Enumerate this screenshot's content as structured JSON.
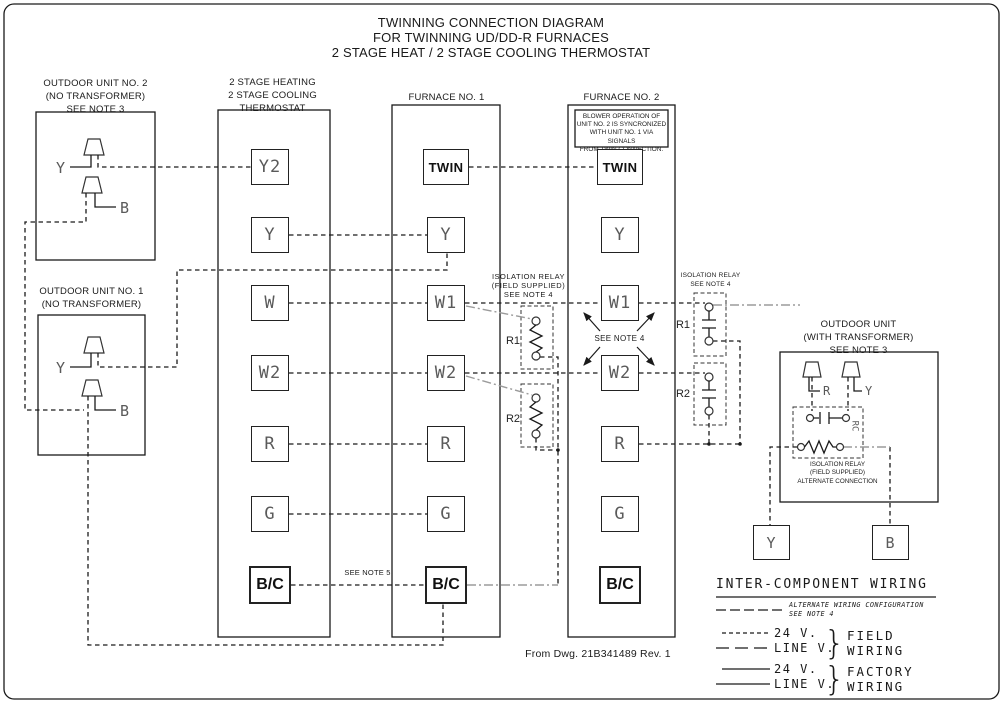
{
  "colors": {
    "line": "#1a1a1a",
    "alternate_wiring": "#9b9b9b"
  },
  "title": {
    "line1": "TWINNING CONNECTION DIAGRAM",
    "line2": "FOR TWINNING UD/DD-R FURNACES",
    "line3": "2 STAGE HEAT / 2 STAGE COOLING THERMOSTAT"
  },
  "outdoor_unit_2": {
    "label1": "OUTDOOR UNIT NO. 2",
    "label2": "(NO TRANSFORMER)",
    "label3": "SEE NOTE 3",
    "terminal_y": "Y",
    "terminal_b": "B"
  },
  "outdoor_unit_1": {
    "label1": "OUTDOOR UNIT NO. 1",
    "label2": "(NO TRANSFORMER)",
    "terminal_y": "Y",
    "terminal_b": "B"
  },
  "thermostat": {
    "header1": "2 STAGE HEATING",
    "header2": "2 STAGE COOLING",
    "header3": "THERMOSTAT",
    "terminals": [
      "Y2",
      "Y",
      "W",
      "W2",
      "R",
      "G",
      "B/C"
    ]
  },
  "furnace_1": {
    "header": "FURNACE NO. 1",
    "terminals": [
      "TWIN",
      "Y",
      "W1",
      "W2",
      "R",
      "G",
      "B/C"
    ]
  },
  "furnace_2": {
    "header": "FURNACE NO. 2",
    "note_lines": [
      "BLOWER OPERATION OF",
      "UNIT NO. 2 IS SYNCRONIZED",
      "WITH UNIT NO. 1 VIA SIGNALS",
      "FROM TWIN CONNECTION."
    ],
    "terminals": [
      "TWIN",
      "Y",
      "W1",
      "W2",
      "R",
      "G",
      "B/C"
    ]
  },
  "isolation_relay_left": {
    "label1": "ISOLATION RELAY",
    "label2": "(FIELD SUPPLIED)",
    "label3": "SEE NOTE 4",
    "relay1": "R1",
    "relay2": "R2"
  },
  "isolation_relay_right": {
    "label1": "ISOLATION RELAY",
    "label2": "SEE NOTE 4",
    "relay1": "R1",
    "relay2": "R2"
  },
  "see_note_4": "SEE NOTE 4",
  "see_note_5": "SEE NOTE 5",
  "outdoor_unit_transformer": {
    "label1": "OUTDOOR UNIT",
    "label2": "(WITH TRANSFORMER)",
    "label3": "SEE NOTE 3",
    "terminal_r": "R",
    "terminal_y": "Y",
    "relay_label": "RC",
    "note1": "ISOLATION RELAY",
    "note2": "(FIELD SUPPLIED)",
    "note3": "ALTERNATE CONNECTION",
    "terminal_y_box": "Y",
    "terminal_b_box": "B"
  },
  "source_note": "From Dwg. 21B341489 Rev. 1",
  "legend": {
    "title": "INTER-COMPONENT WIRING",
    "alternate1": "ALTERNATE WIRING CONFIGURATION",
    "alternate2": "SEE NOTE 4",
    "field_24v": "24 V.",
    "field_line": "LINE V.",
    "field_label1": "FIELD",
    "field_label2": "WIRING",
    "factory_24v": "24 V.",
    "factory_line": "LINE V.",
    "factory_label1": "FACTORY",
    "factory_label2": "WIRING",
    "brace": "}"
  }
}
